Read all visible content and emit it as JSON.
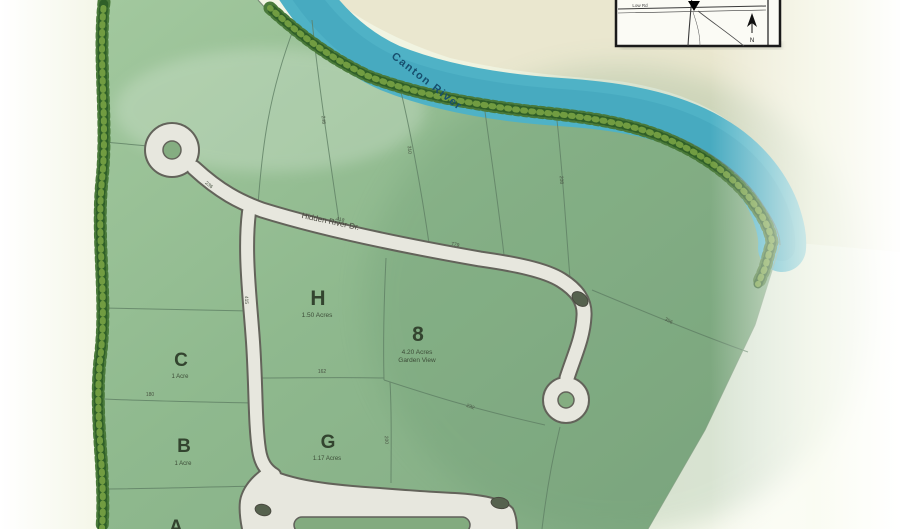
{
  "map": {
    "river_label": "Canton River",
    "road_label": "Hidden River Dr.",
    "lots": {
      "h": {
        "letter": "H",
        "area": "1.50 Acres"
      },
      "eight": {
        "letter": "8",
        "area": "4.20 Acres",
        "note": "Garden View"
      },
      "c": {
        "letter": "C",
        "area": "1 Acre"
      },
      "b": {
        "letter": "B",
        "area": "1 Acre"
      },
      "g": {
        "letter": "G",
        "area": "1.17 Acres"
      },
      "a": {
        "letter": "A"
      }
    },
    "dims": [
      "236",
      "418",
      "779",
      "248",
      "310",
      "208",
      "356",
      "415",
      "232",
      "162",
      "180",
      "200"
    ],
    "colors": {
      "plat_green": "#8fb98e",
      "river_teal": "#4fb2c6",
      "road_fill": "#e7e7de",
      "road_outline": "#63635a",
      "tree_dark": "#2f5f28",
      "far_bank_cream": "#eae7cf",
      "lot_text": "#33442f",
      "river_text": "#174f6e"
    }
  },
  "inset": {
    "road_label": "Low Rd",
    "north_label": "N"
  }
}
